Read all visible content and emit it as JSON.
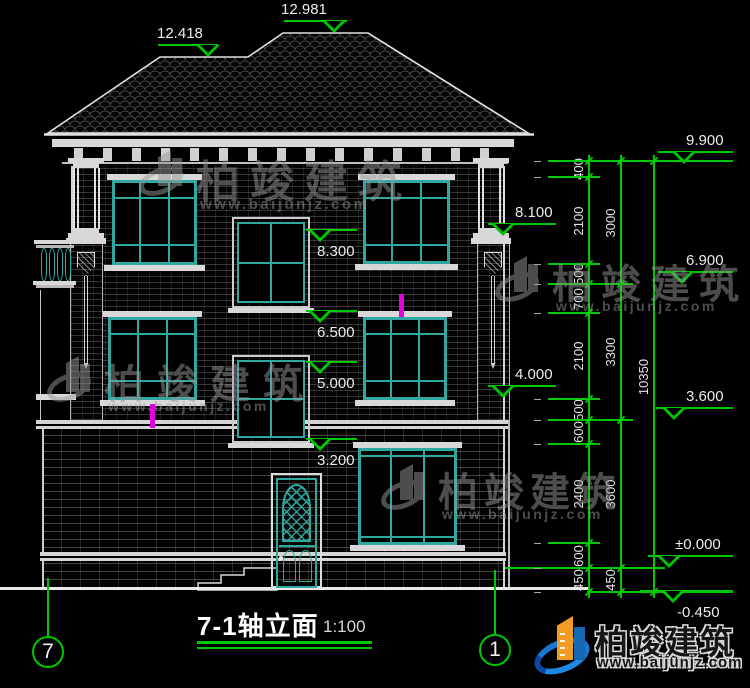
{
  "title": {
    "name": "7-1轴立面",
    "scale": "1:100"
  },
  "brand": {
    "name": "柏竣建筑",
    "url": "www.baijunjz.com"
  },
  "roof_marks": [
    "12.418",
    "12.981"
  ],
  "axis_bubbles": [
    {
      "label": "7",
      "cx": 48,
      "cy": 652,
      "leader_top": 578
    },
    {
      "label": "1",
      "cx": 495,
      "cy": 650,
      "leader_top": 570
    }
  ],
  "elevations": [
    {
      "value": "12.418",
      "x1": 158,
      "x2": 218,
      "y": 45,
      "tri_x": 196,
      "text_x": 157,
      "side": "above"
    },
    {
      "value": "12.981",
      "x1": 284,
      "x2": 347,
      "y": 21,
      "tri_x": 322,
      "text_x": 281,
      "side": "above"
    },
    {
      "value": "9.900",
      "x1": 658,
      "x2": 733,
      "y": 152,
      "tri_x": 672,
      "text_x": 686,
      "side": "above"
    },
    {
      "value": "8.100",
      "x1": 488,
      "x2": 556,
      "y": 224,
      "tri_x": 491,
      "text_x": 515,
      "side": "above"
    },
    {
      "value": "8.300",
      "x1": 306,
      "x2": 357,
      "y": 230,
      "tri_x": 308,
      "text_x": 317,
      "side": "below"
    },
    {
      "value": "6.900",
      "x1": 658,
      "x2": 733,
      "y": 272,
      "tri_x": 670,
      "text_x": 686,
      "side": "above"
    },
    {
      "value": "6.500",
      "x1": 306,
      "x2": 357,
      "y": 311,
      "tri_x": 308,
      "text_x": 317,
      "side": "below"
    },
    {
      "value": "5.000",
      "x1": 306,
      "x2": 357,
      "y": 362,
      "tri_x": 308,
      "text_x": 317,
      "side": "below"
    },
    {
      "value": "4.000",
      "x1": 488,
      "x2": 556,
      "y": 386,
      "tri_x": 491,
      "text_x": 515,
      "side": "above"
    },
    {
      "value": "3.600",
      "x1": 656,
      "x2": 733,
      "y": 408,
      "tri_x": 662,
      "text_x": 686,
      "side": "above"
    },
    {
      "value": "3.200",
      "x1": 306,
      "x2": 357,
      "y": 439,
      "tri_x": 308,
      "text_x": 317,
      "side": "below"
    },
    {
      "value": "±0.000",
      "x1": 648,
      "x2": 733,
      "y": 556,
      "tri_x": 657,
      "text_x": 675,
      "side": "above"
    },
    {
      "value": "-0.450",
      "x1": 640,
      "x2": 733,
      "y": 591,
      "tri_x": 661,
      "text_x": 677,
      "side": "below"
    }
  ],
  "dimension_chains": [
    {
      "x": 588,
      "bounds": [
        161,
        177,
        264,
        284,
        313,
        399,
        420,
        444,
        543,
        568,
        592
      ],
      "labels": [
        "400",
        "2100",
        "500",
        "700",
        "2100",
        "500",
        "600",
        "2400",
        "600",
        "450"
      ]
    },
    {
      "x": 620,
      "bounds": [
        161,
        284,
        420,
        568,
        592
      ],
      "labels": [
        "3000",
        "3300",
        "3600",
        "450"
      ]
    },
    {
      "x": 653,
      "bounds": [
        161,
        592
      ],
      "labels": [
        "10350"
      ]
    }
  ],
  "tick_lines": [
    {
      "y": 161,
      "x1": 548,
      "x2": 733
    },
    {
      "y": 177,
      "x1": 548,
      "x2": 600
    },
    {
      "y": 264,
      "x1": 548,
      "x2": 600
    },
    {
      "y": 284,
      "x1": 548,
      "x2": 633
    },
    {
      "y": 313,
      "x1": 548,
      "x2": 600
    },
    {
      "y": 399,
      "x1": 548,
      "x2": 600
    },
    {
      "y": 420,
      "x1": 548,
      "x2": 633
    },
    {
      "y": 444,
      "x1": 548,
      "x2": 600
    },
    {
      "y": 543,
      "x1": 548,
      "x2": 600
    },
    {
      "y": 568,
      "x1": 505,
      "x2": 665
    },
    {
      "y": 592,
      "x1": 587,
      "x2": 733
    }
  ],
  "magenta_marks": [
    {
      "x": 150,
      "y": 404,
      "w": 5,
      "h": 24
    },
    {
      "x": 399,
      "y": 294,
      "w": 5,
      "h": 23
    }
  ],
  "colors": {
    "background": "#000000",
    "line_white": "#e6e6e6",
    "dim_green": "#00c800",
    "window_teal": "#2fa8a0",
    "magenta": "#e000e0",
    "watermark_gray": "#9a9a9a",
    "logo_blue": "#1467b3",
    "logo_orange": "#f49b25"
  }
}
